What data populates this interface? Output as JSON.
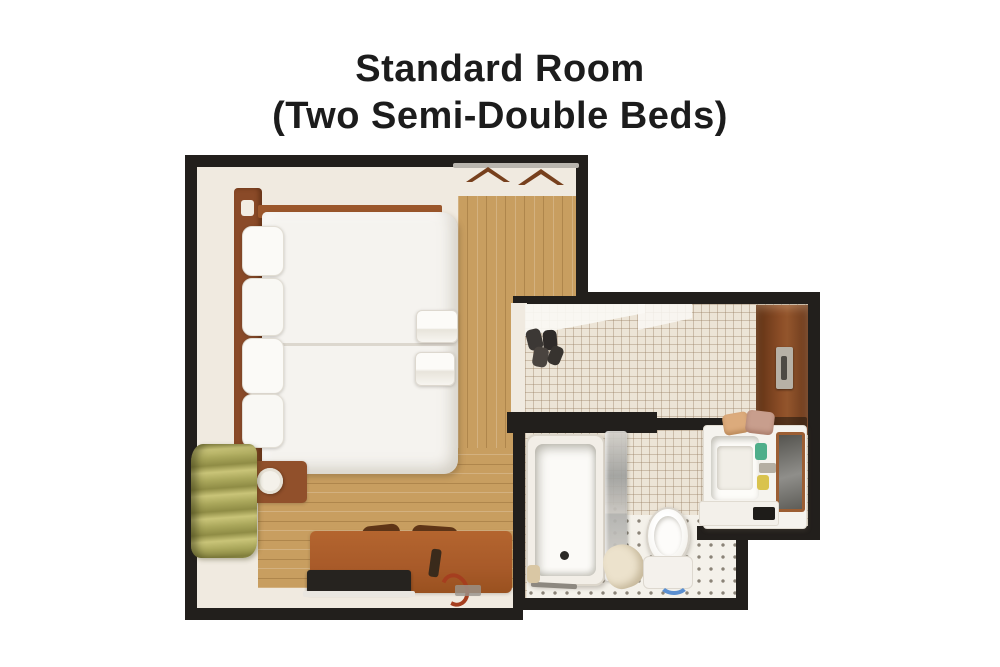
{
  "title": {
    "line1": "Standard Room",
    "line2": "(Two Semi-Double Beds)"
  },
  "palette": {
    "background": "#ffffff",
    "title_text": "#1c1c1c",
    "wall": "#221f1c",
    "bedroom_floor": "#f0eae0",
    "wood_floor": "#c89e60",
    "bed_linen": "#f5f3ef",
    "furniture_wood": "#8a4a28",
    "curtain_green": "#a8a455",
    "corridor_tile": "#ece4d6",
    "bathroom_floor": "#f4f1ea",
    "door_brown": "#7b431f",
    "towel_tan": "#dcab7c",
    "fixture_white": "#f6f4ef",
    "toilet_accent_blue": "#5b8fd0",
    "amenity_green": "#4fae8a",
    "amenity_yellow": "#d9c34e"
  },
  "plan": {
    "rooms": [
      "bedroom",
      "entry-corridor",
      "bathroom"
    ],
    "bedroom_items": [
      "headboard",
      "two semi-double beds",
      "pillows",
      "folded foot towels",
      "nightstand",
      "table lamp",
      "green window curtain",
      "desk",
      "chairs",
      "tv",
      "clothes rail",
      "hangers"
    ],
    "corridor_items": [
      "entrance door",
      "door handle",
      "shoes"
    ],
    "bathroom_items": [
      "bathtub",
      "glass shower partition",
      "toilet with bidet seat",
      "washbasin vanity",
      "mirror",
      "rolled towels",
      "bath robe",
      "amenity bottles"
    ]
  }
}
